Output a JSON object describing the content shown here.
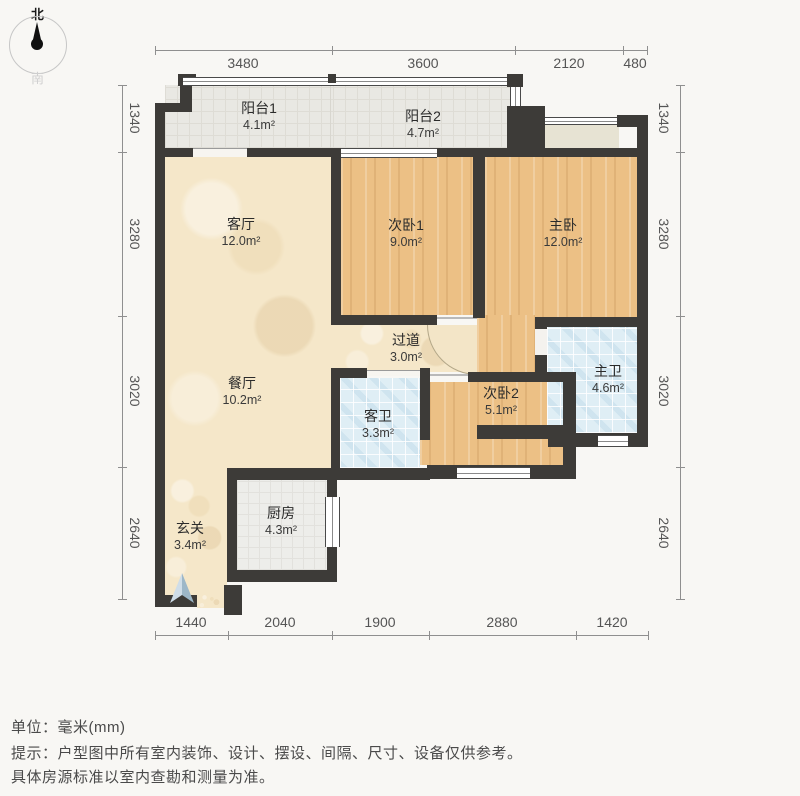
{
  "compass": {
    "north": "北",
    "south": "南"
  },
  "rooms": {
    "balcony1": {
      "name": "阳台1",
      "area": "4.1m²"
    },
    "balcony2": {
      "name": "阳台2",
      "area": "4.7m²"
    },
    "living": {
      "name": "客厅",
      "area": "12.0m²"
    },
    "bedroom1": {
      "name": "次卧1",
      "area": "9.0m²"
    },
    "master": {
      "name": "主卧",
      "area": "12.0m²"
    },
    "hallway": {
      "name": "过道",
      "area": "3.0m²"
    },
    "dining": {
      "name": "餐厅",
      "area": "10.2m²"
    },
    "guest_bath": {
      "name": "客卫",
      "area": "3.3m²"
    },
    "bedroom2": {
      "name": "次卧2",
      "area": "5.1m²"
    },
    "master_bath": {
      "name": "主卫",
      "area": "4.6m²"
    },
    "entry": {
      "name": "玄关",
      "area": "3.4m²"
    },
    "kitchen": {
      "name": "厨房",
      "area": "4.3m²"
    }
  },
  "dimensions": {
    "top": [
      "3480",
      "3600",
      "2120",
      "480"
    ],
    "bottom": [
      "1440",
      "2040",
      "1900",
      "2880",
      "1420"
    ],
    "left": [
      "1340",
      "3280",
      "3020",
      "2640"
    ],
    "right": [
      "1340",
      "3280",
      "3020",
      "2640"
    ]
  },
  "footer": {
    "unit": "单位：毫米(mm)",
    "note1": "提示：户型图中所有室内装饰、设计、摆设、间隔、尺寸、设备仅供参考。",
    "note2": "具体房源标准以室内查勘和测量为准。"
  },
  "colors": {
    "wall": "#3d3b38",
    "wood_floor": "#ecc085",
    "cream_floor": "#f5e7c9",
    "blue_tile": "#dfeef5",
    "balcony_tile": "#e9e8e3",
    "kitchen_tile": "#ededea",
    "entry_arrow": "#9db7c8"
  }
}
